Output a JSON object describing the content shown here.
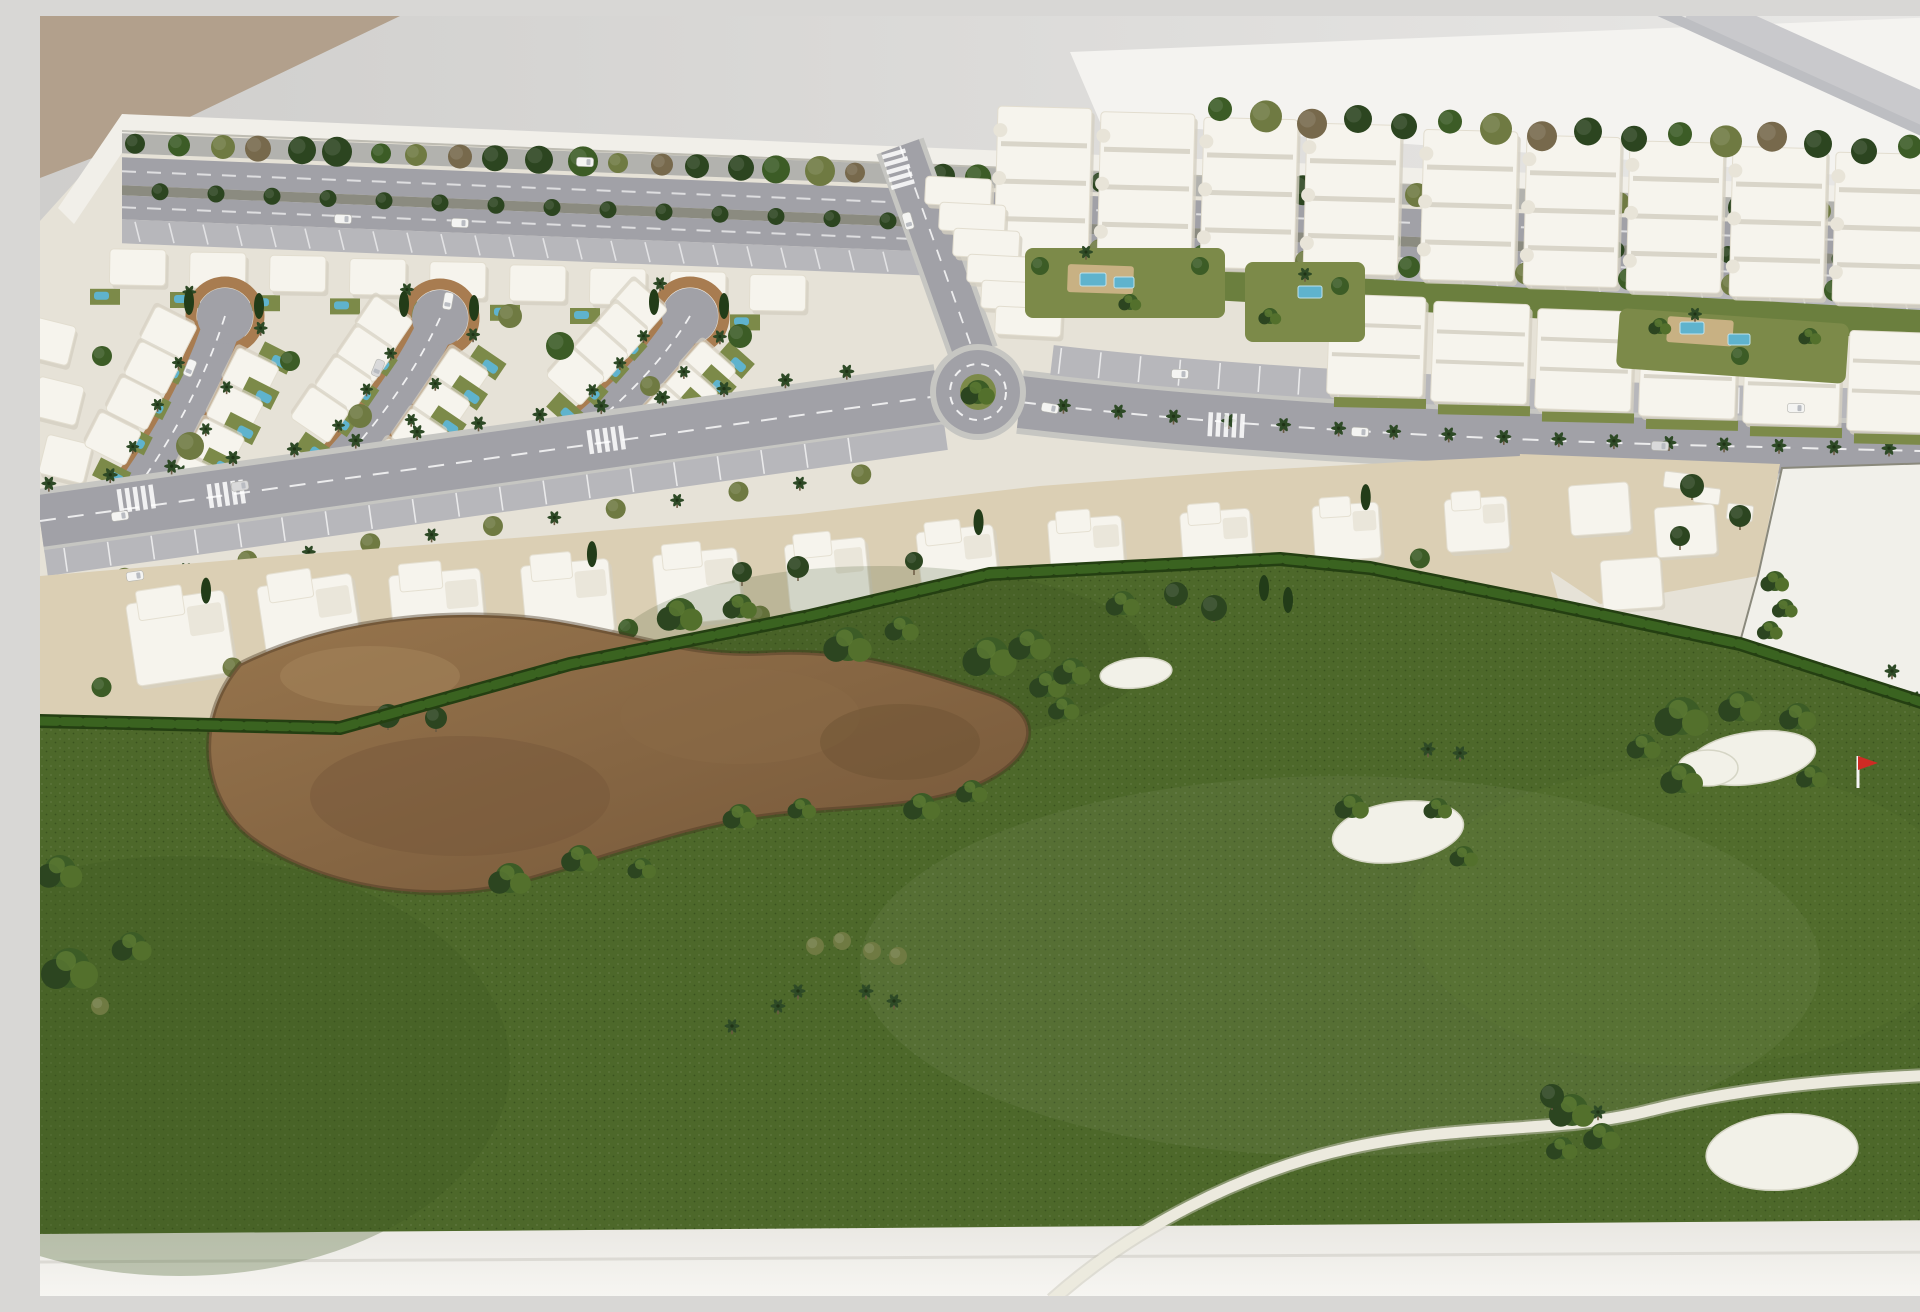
{
  "meta": {
    "title": "Architectural scale model photograph: resort masterplan with white villa blocks, apartment buildings, palm-lined avenues, roundabout and golf course with bunkers and red flag",
    "type": "photograph"
  },
  "palette": {
    "wallTop": "#cfcecc",
    "wallBottom": "#e9e8e6",
    "tanWall": "#b2a08c",
    "bright": "#f4f3f0",
    "stripe1": "#c9c9cc",
    "stripe2": "#bdbec2",
    "rim": "#f1efe9",
    "base": "#e9e7e2",
    "baseBright": "#f7f6f2",
    "ground": "#e6e2d7",
    "road": "#a1a1a7",
    "roadEdge": "#c6c6c2",
    "roadLight": "#b7b7bb",
    "farRoad": "#b2b2ae",
    "median": "#8b8b80",
    "curb": "#a87c50",
    "sand": "#dbcfb4",
    "bldg": "#f6f4ed",
    "bldgShade": "#d5d0c2",
    "bldgLine": "#d9d5c9",
    "lawn": "#7c8a49",
    "lawnDark": "#6b7f3e",
    "pool": "#5fb3cd",
    "poolDeck": "#c8b183",
    "hedge": "#2f5318",
    "hedgeDark": "#243f12",
    "hedgeLight": "#3a6320",
    "golf": "#4d682a",
    "golfDark": "#3f5820",
    "golfLight": "#6c8738",
    "waste": "#97754d",
    "wasteDark": "#755739",
    "wasteEdge": "#43331f",
    "bunker": "#f2f1e8",
    "path": "#eceade",
    "pathEdge": "#c9c7ba",
    "treeDark": "#2c4520",
    "tree": "#3c5c26",
    "treeOlive": "#6f7a42",
    "treeBrown": "#77694c",
    "palm": "#2e4a26",
    "trunk": "#6b5a42",
    "cypress": "#223c18",
    "car": "#f4f4f2",
    "carGlass": "#b9bcc2",
    "flag": "#cf2b24",
    "white": "#ffffff"
  },
  "background": {
    "tan_polygon": "0,0 360,0 110,120 0,162",
    "bright_polygon": "1030,36 1925,0 1925,168 1060,106",
    "stripes": [
      {
        "x1": 1650,
        "y1": -8,
        "x2": 1952,
        "y2": 128,
        "w": 40,
        "color": "#c9c9cc"
      },
      {
        "x1": 1612,
        "y1": -8,
        "x2": 1915,
        "y2": 130,
        "w": 10,
        "color": "#bdbec2"
      }
    ]
  },
  "model": {
    "rim_y0": 98,
    "rim_slope": 0.04,
    "rim": "82,98 1925,175 1925,191 82,114",
    "wedge": "82,98 18,192 34,208 96,116",
    "ground": "82,114 1925,191 1925,1204 0,1218 0,205",
    "base": "0,1218 1925,1204 1925,1282 0,1282"
  },
  "roads": {
    "left_avenue": {
      "x1": 0,
      "y1": 505,
      "x2": 898,
      "y2": 380,
      "w": 52
    },
    "link_road": {
      "x1": 860,
      "y1": 130,
      "x2": 934,
      "y2": 338,
      "w": 40
    },
    "right_avenue": {
      "path": "M980,386 C1200,412 1450,424 1680,430 C1800,433 1880,435 1925,436",
      "w": 52
    },
    "right_parking": {
      "path": "M1012,344 C1200,366 1450,378 1680,384 C1800,387 1880,389 1925,390",
      "w": 30
    },
    "roundabout": {
      "cx": 938,
      "cy": 376,
      "r": 42
    },
    "teardrops": [
      {
        "bx": 185,
        "by": 300,
        "ex": 100,
        "ey": 468,
        "r": 28,
        "w": 38
      },
      {
        "bx": 400,
        "by": 302,
        "ex": 302,
        "ey": 446,
        "r": 28,
        "w": 38
      },
      {
        "bx": 650,
        "by": 300,
        "ex": 554,
        "ey": 408,
        "r": 28,
        "w": 38
      }
    ]
  },
  "districts": {
    "villa_top_row": {
      "x0": 70,
      "step": 80,
      "count": 9,
      "w": 56,
      "h": 36
    },
    "left_column": [
      [
        -8,
        300
      ],
      [
        0,
        360
      ],
      [
        8,
        418
      ]
    ],
    "villa_trees": [
      [
        250,
        345
      ],
      [
        320,
        400
      ],
      [
        520,
        330
      ],
      [
        610,
        370
      ],
      [
        700,
        320
      ],
      [
        150,
        430
      ],
      [
        62,
        340
      ],
      [
        470,
        300
      ],
      [
        590,
        430
      ],
      [
        720,
        400
      ]
    ],
    "townhouse_arc": [
      [
        20,
        665
      ],
      [
        240,
        632
      ],
      [
        500,
        608
      ],
      [
        760,
        582
      ],
      [
        1000,
        555
      ],
      [
        1200,
        540
      ],
      [
        1380,
        528
      ],
      [
        1470,
        522
      ]
    ],
    "townhouse_sand": "0,560 240,540 500,520 760,498 1000,470 1200,455 1380,445 1480,440 1520,590 1330,552 1240,543 950,558 770,600 530,648 300,712 0,705",
    "apartments_upper": {
      "x0": 958,
      "step": 103,
      "count": 9,
      "w": 94,
      "h": 150
    },
    "apartments_lower": {
      "x0": 1290,
      "step": 104,
      "count": 6,
      "w": 96,
      "h": 100
    },
    "upper_front_strip": "958,242 1880,294 1880,324 958,272",
    "stepped_terraces": {
      "x0": 886,
      "y0": 160,
      "dx": 14,
      "dy": 26,
      "count": 6,
      "w": 66,
      "h": 28
    },
    "right_sector_sand": "1480,438 1740,448 1718,560 1560,588 1470,528",
    "parcel": "1718,560 1742,452 1925,446 1925,692 1700,626",
    "right_clusters": [
      [
        1528,
        470
      ],
      [
        1614,
        492
      ],
      [
        1560,
        545
      ]
    ],
    "terraces": [
      [
        1625,
        455
      ],
      [
        1655,
        470
      ],
      [
        1688,
        487
      ]
    ],
    "courts": [
      [
        985,
        232,
        200,
        70,
        0
      ],
      [
        1205,
        246,
        120,
        80,
        0
      ],
      [
        1580,
        292,
        230,
        60,
        4
      ]
    ],
    "decks": [
      [
        1028,
        248,
        66,
        28,
        2
      ],
      [
        1628,
        300,
        66,
        26,
        4
      ]
    ],
    "pools": [
      [
        1040,
        257,
        26,
        13
      ],
      [
        1074,
        261,
        20,
        11
      ],
      [
        1258,
        270,
        24,
        12
      ],
      [
        1640,
        306,
        24,
        12
      ],
      [
        1688,
        318,
        22,
        11
      ]
    ]
  },
  "golf": {
    "green": "0,705 300,712 530,648 770,600 950,558 1240,543 1330,552 1520,590 1700,628 1925,700 1925,1204 0,1218",
    "hedge": "0,705 300,712 530,648 770,600 950,558 1240,543 1330,552 1520,590 1700,628 1925,700",
    "waste": "M200,648 C300,598 430,590 525,607 C610,622 655,641 725,637 C805,632 865,650 950,678 C1008,698 998,742 938,769 C878,795 798,789 718,801 C638,813 558,845 468,869 C388,888 278,872 210,821 C162,783 152,704 200,648 Z",
    "bunkers": [
      [
        1096,
        657,
        36,
        15,
        -6
      ],
      [
        1358,
        816,
        66,
        30,
        -8
      ],
      [
        1712,
        742,
        64,
        26,
        -8
      ],
      [
        1668,
        752,
        30,
        18,
        0
      ],
      [
        1742,
        1136,
        76,
        38,
        -4
      ]
    ],
    "flag": {
      "x": 1818,
      "y": 740,
      "h": 32
    },
    "cart_path": "M1012,1284 C1090,1214 1200,1156 1310,1132 C1430,1106 1520,1118 1612,1094 C1700,1072 1800,1062 1928,1058",
    "bushes": [
      [
        640,
        598,
        16
      ],
      [
        700,
        590,
        12
      ],
      [
        808,
        628,
        17
      ],
      [
        862,
        612,
        12
      ],
      [
        950,
        640,
        19
      ],
      [
        1008,
        668,
        13
      ],
      [
        1024,
        692,
        11
      ],
      [
        1083,
        587,
        12
      ],
      [
        990,
        628,
        15
      ],
      [
        1032,
        655,
        13
      ],
      [
        470,
        862,
        15
      ],
      [
        540,
        842,
        13
      ],
      [
        602,
        852,
        10
      ],
      [
        700,
        800,
        12
      ],
      [
        762,
        792,
        10
      ],
      [
        882,
        790,
        13
      ],
      [
        932,
        775,
        11
      ],
      [
        30,
        952,
        20
      ],
      [
        92,
        930,
        14
      ],
      [
        20,
        855,
        16
      ],
      [
        1312,
        790,
        12
      ],
      [
        1398,
        792,
        10
      ],
      [
        1424,
        840,
        10
      ],
      [
        1642,
        700,
        19
      ],
      [
        1700,
        690,
        15
      ],
      [
        1758,
        700,
        13
      ],
      [
        1604,
        730,
        12
      ],
      [
        1642,
        762,
        15
      ],
      [
        1772,
        760,
        11
      ],
      [
        1532,
        1094,
        16
      ],
      [
        1562,
        1120,
        13
      ],
      [
        1522,
        1132,
        11
      ],
      [
        1735,
        565,
        10
      ],
      [
        1745,
        592,
        9
      ],
      [
        1730,
        614,
        9
      ]
    ],
    "trees": [
      [
        348,
        700,
        12
      ],
      [
        396,
        702,
        11
      ],
      [
        702,
        556,
        10
      ],
      [
        758,
        551,
        11
      ],
      [
        1136,
        578,
        12
      ],
      [
        1174,
        592,
        13
      ],
      [
        874,
        545,
        9
      ],
      [
        1512,
        1080,
        12
      ],
      [
        1652,
        470,
        12
      ],
      [
        1700,
        500,
        11
      ],
      [
        1640,
        520,
        10
      ]
    ],
    "cypresses": [
      [
        1224,
        572
      ],
      [
        1248,
        584
      ],
      [
        1895,
        640
      ]
    ],
    "palms": [
      [
        692,
        1010
      ],
      [
        738,
        990
      ],
      [
        758,
        975
      ],
      [
        826,
        975
      ],
      [
        854,
        985
      ],
      [
        1388,
        733
      ],
      [
        1420,
        737
      ],
      [
        1852,
        655
      ],
      [
        1874,
        682
      ],
      [
        1558,
        1096
      ]
    ],
    "olives": [
      [
        775,
        930
      ],
      [
        802,
        925
      ],
      [
        832,
        935
      ],
      [
        858,
        940
      ],
      [
        60,
        990
      ]
    ]
  },
  "cars": [
    [
      545,
      146,
      2
    ],
    [
      420,
      207,
      2
    ],
    [
      303,
      203,
      2
    ],
    [
      200,
      470,
      -8
    ],
    [
      80,
      500,
      -8
    ],
    [
      95,
      560,
      -8
    ],
    [
      408,
      285,
      100
    ],
    [
      338,
      352,
      112
    ],
    [
      150,
      352,
      112
    ],
    [
      868,
      205,
      74
    ],
    [
      1320,
      416,
      3
    ],
    [
      1620,
      430,
      2
    ],
    [
      1010,
      392,
      10
    ],
    [
      1140,
      358,
      2
    ],
    [
      1756,
      392,
      2
    ]
  ],
  "crosswalks": [
    [
      185,
      478,
      -8
    ],
    [
      565,
      424,
      -8
    ],
    [
      858,
      152,
      74
    ],
    [
      1185,
      409,
      3
    ],
    [
      95,
      483,
      -8
    ]
  ]
}
